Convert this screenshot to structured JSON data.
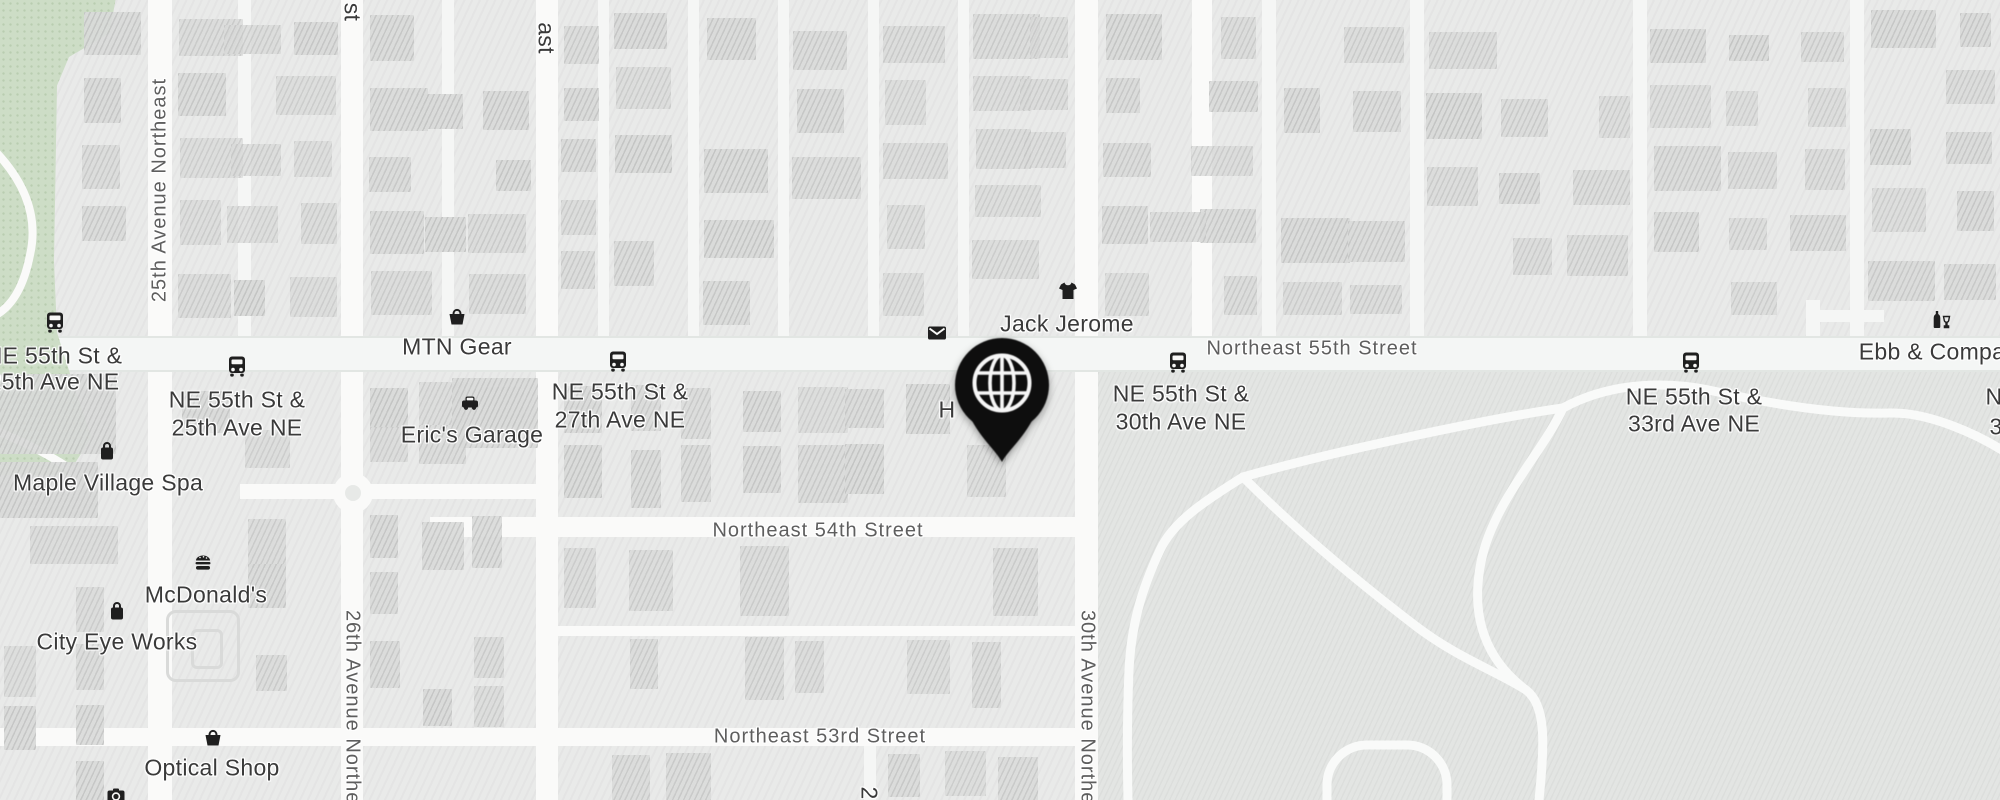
{
  "colors": {
    "pin": "#0e0e0e",
    "icon": "#1f1f1f",
    "poi_text": "#3a3a3a",
    "street_text": "#5e5e5e",
    "park": "#cdddc6",
    "golf_area": "#e3e5e3",
    "road": "#fafaf9",
    "block": "#e9eae9",
    "building": "#dadbda"
  },
  "pin": {
    "icon": "globe-icon",
    "x": 1002,
    "y": 385
  },
  "street_labels": [
    {
      "text": "Northeast 55th Street",
      "x": 1312,
      "y": 349,
      "rotate": 0
    },
    {
      "text": "Northeast 54th Street",
      "x": 818,
      "y": 531,
      "rotate": 0
    },
    {
      "text": "Northeast 53rd Street",
      "x": 820,
      "y": 737,
      "rotate": 0
    },
    {
      "text": "25th Avenue Northeast",
      "x": 160,
      "y": 190,
      "rotate": -90
    },
    {
      "text": "26th Avenue Northeast",
      "x": 352,
      "y": 722,
      "rotate": 90
    },
    {
      "text": "30th Avenue Northeast",
      "x": 1087,
      "y": 722,
      "rotate": 90
    }
  ],
  "label_fragments": [
    {
      "text": "st",
      "x": 352,
      "y": 12,
      "rotate": 90
    },
    {
      "text": "ast",
      "x": 546,
      "y": 38,
      "rotate": 90
    },
    {
      "text": "2",
      "x": 869,
      "y": 793,
      "rotate": 90
    },
    {
      "text": "N",
      "x": 1994,
      "y": 397,
      "rotate": 0
    },
    {
      "text": "3",
      "x": 1996,
      "y": 427,
      "rotate": 0
    },
    {
      "text": "H",
      "x": 947,
      "y": 410,
      "rotate": 0
    }
  ],
  "pois": [
    {
      "id": "bus-stop-ne-55th-st-25th-ave-west",
      "icon": "bus-icon",
      "lines": [
        "NE 55th St &",
        "25th Ave NE"
      ],
      "icon_x": 55,
      "icon_y": 322,
      "label_x": 54,
      "label_y": 356,
      "line_gap": 26
    },
    {
      "id": "bus-stop-ne-55th-st-25th-ave",
      "icon": "bus-icon",
      "lines": [
        "NE 55th St &",
        "25th Ave NE"
      ],
      "icon_x": 237,
      "icon_y": 366,
      "label_x": 237,
      "label_y": 400,
      "line_gap": 28
    },
    {
      "id": "maple-village-spa",
      "icon": "shopping-bag-icon",
      "lines": [
        "Maple Village Spa"
      ],
      "icon_x": 107,
      "icon_y": 451,
      "label_x": 108,
      "label_y": 483
    },
    {
      "id": "mtn-gear",
      "icon": "shopping-basket-icon",
      "lines": [
        "MTN Gear"
      ],
      "icon_x": 457,
      "icon_y": 316,
      "label_x": 457,
      "label_y": 347
    },
    {
      "id": "erics-garage",
      "icon": "car-icon",
      "lines": [
        "Eric's Garage"
      ],
      "icon_x": 470,
      "icon_y": 403,
      "label_x": 472,
      "label_y": 435
    },
    {
      "id": "bus-stop-ne-55th-st-27th-ave",
      "icon": "bus-icon",
      "lines": [
        "NE 55th St &",
        "27th Ave NE"
      ],
      "icon_x": 618,
      "icon_y": 361,
      "label_x": 620,
      "label_y": 392,
      "line_gap": 28
    },
    {
      "id": "mail-point",
      "icon": "mail-icon",
      "lines": [],
      "icon_x": 937,
      "icon_y": 333
    },
    {
      "id": "jack-jerome",
      "icon": "tshirt-icon",
      "lines": [
        "Jack Jerome"
      ],
      "icon_x": 1068,
      "icon_y": 291,
      "label_x": 1067,
      "label_y": 324
    },
    {
      "id": "bus-stop-ne-55th-st-30th-ave",
      "icon": "bus-icon",
      "lines": [
        "NE 55th St &",
        "30th Ave NE"
      ],
      "icon_x": 1178,
      "icon_y": 362,
      "label_x": 1181,
      "label_y": 394,
      "line_gap": 28
    },
    {
      "id": "bus-stop-ne-55th-st-33rd-ave",
      "icon": "bus-icon",
      "lines": [
        "NE 55th St &",
        "33rd Ave NE"
      ],
      "icon_x": 1691,
      "icon_y": 362,
      "label_x": 1694,
      "label_y": 397,
      "line_gap": 27
    },
    {
      "id": "ebb-and-company",
      "icon": "bar-icon",
      "lines": [
        "Ebb & Compa"
      ],
      "icon_x": 1941,
      "icon_y": 320,
      "label_x": 1932,
      "label_y": 352
    },
    {
      "id": "mcdonalds",
      "icon": "burger-icon",
      "lines": [
        "McDonald's"
      ],
      "icon_x": 203,
      "icon_y": 562,
      "label_x": 206,
      "label_y": 595
    },
    {
      "id": "city-eye-works",
      "icon": "shopping-bag-icon",
      "lines": [
        "City Eye Works"
      ],
      "icon_x": 117,
      "icon_y": 611,
      "label_x": 117,
      "label_y": 642
    },
    {
      "id": "optical-shop",
      "icon": "shopping-basket-icon",
      "lines": [
        "Optical Shop"
      ],
      "icon_x": 213,
      "icon_y": 737,
      "label_x": 212,
      "label_y": 768
    },
    {
      "id": "photo-spot",
      "icon": "camera-icon",
      "lines": [],
      "icon_x": 116,
      "icon_y": 796
    }
  ]
}
